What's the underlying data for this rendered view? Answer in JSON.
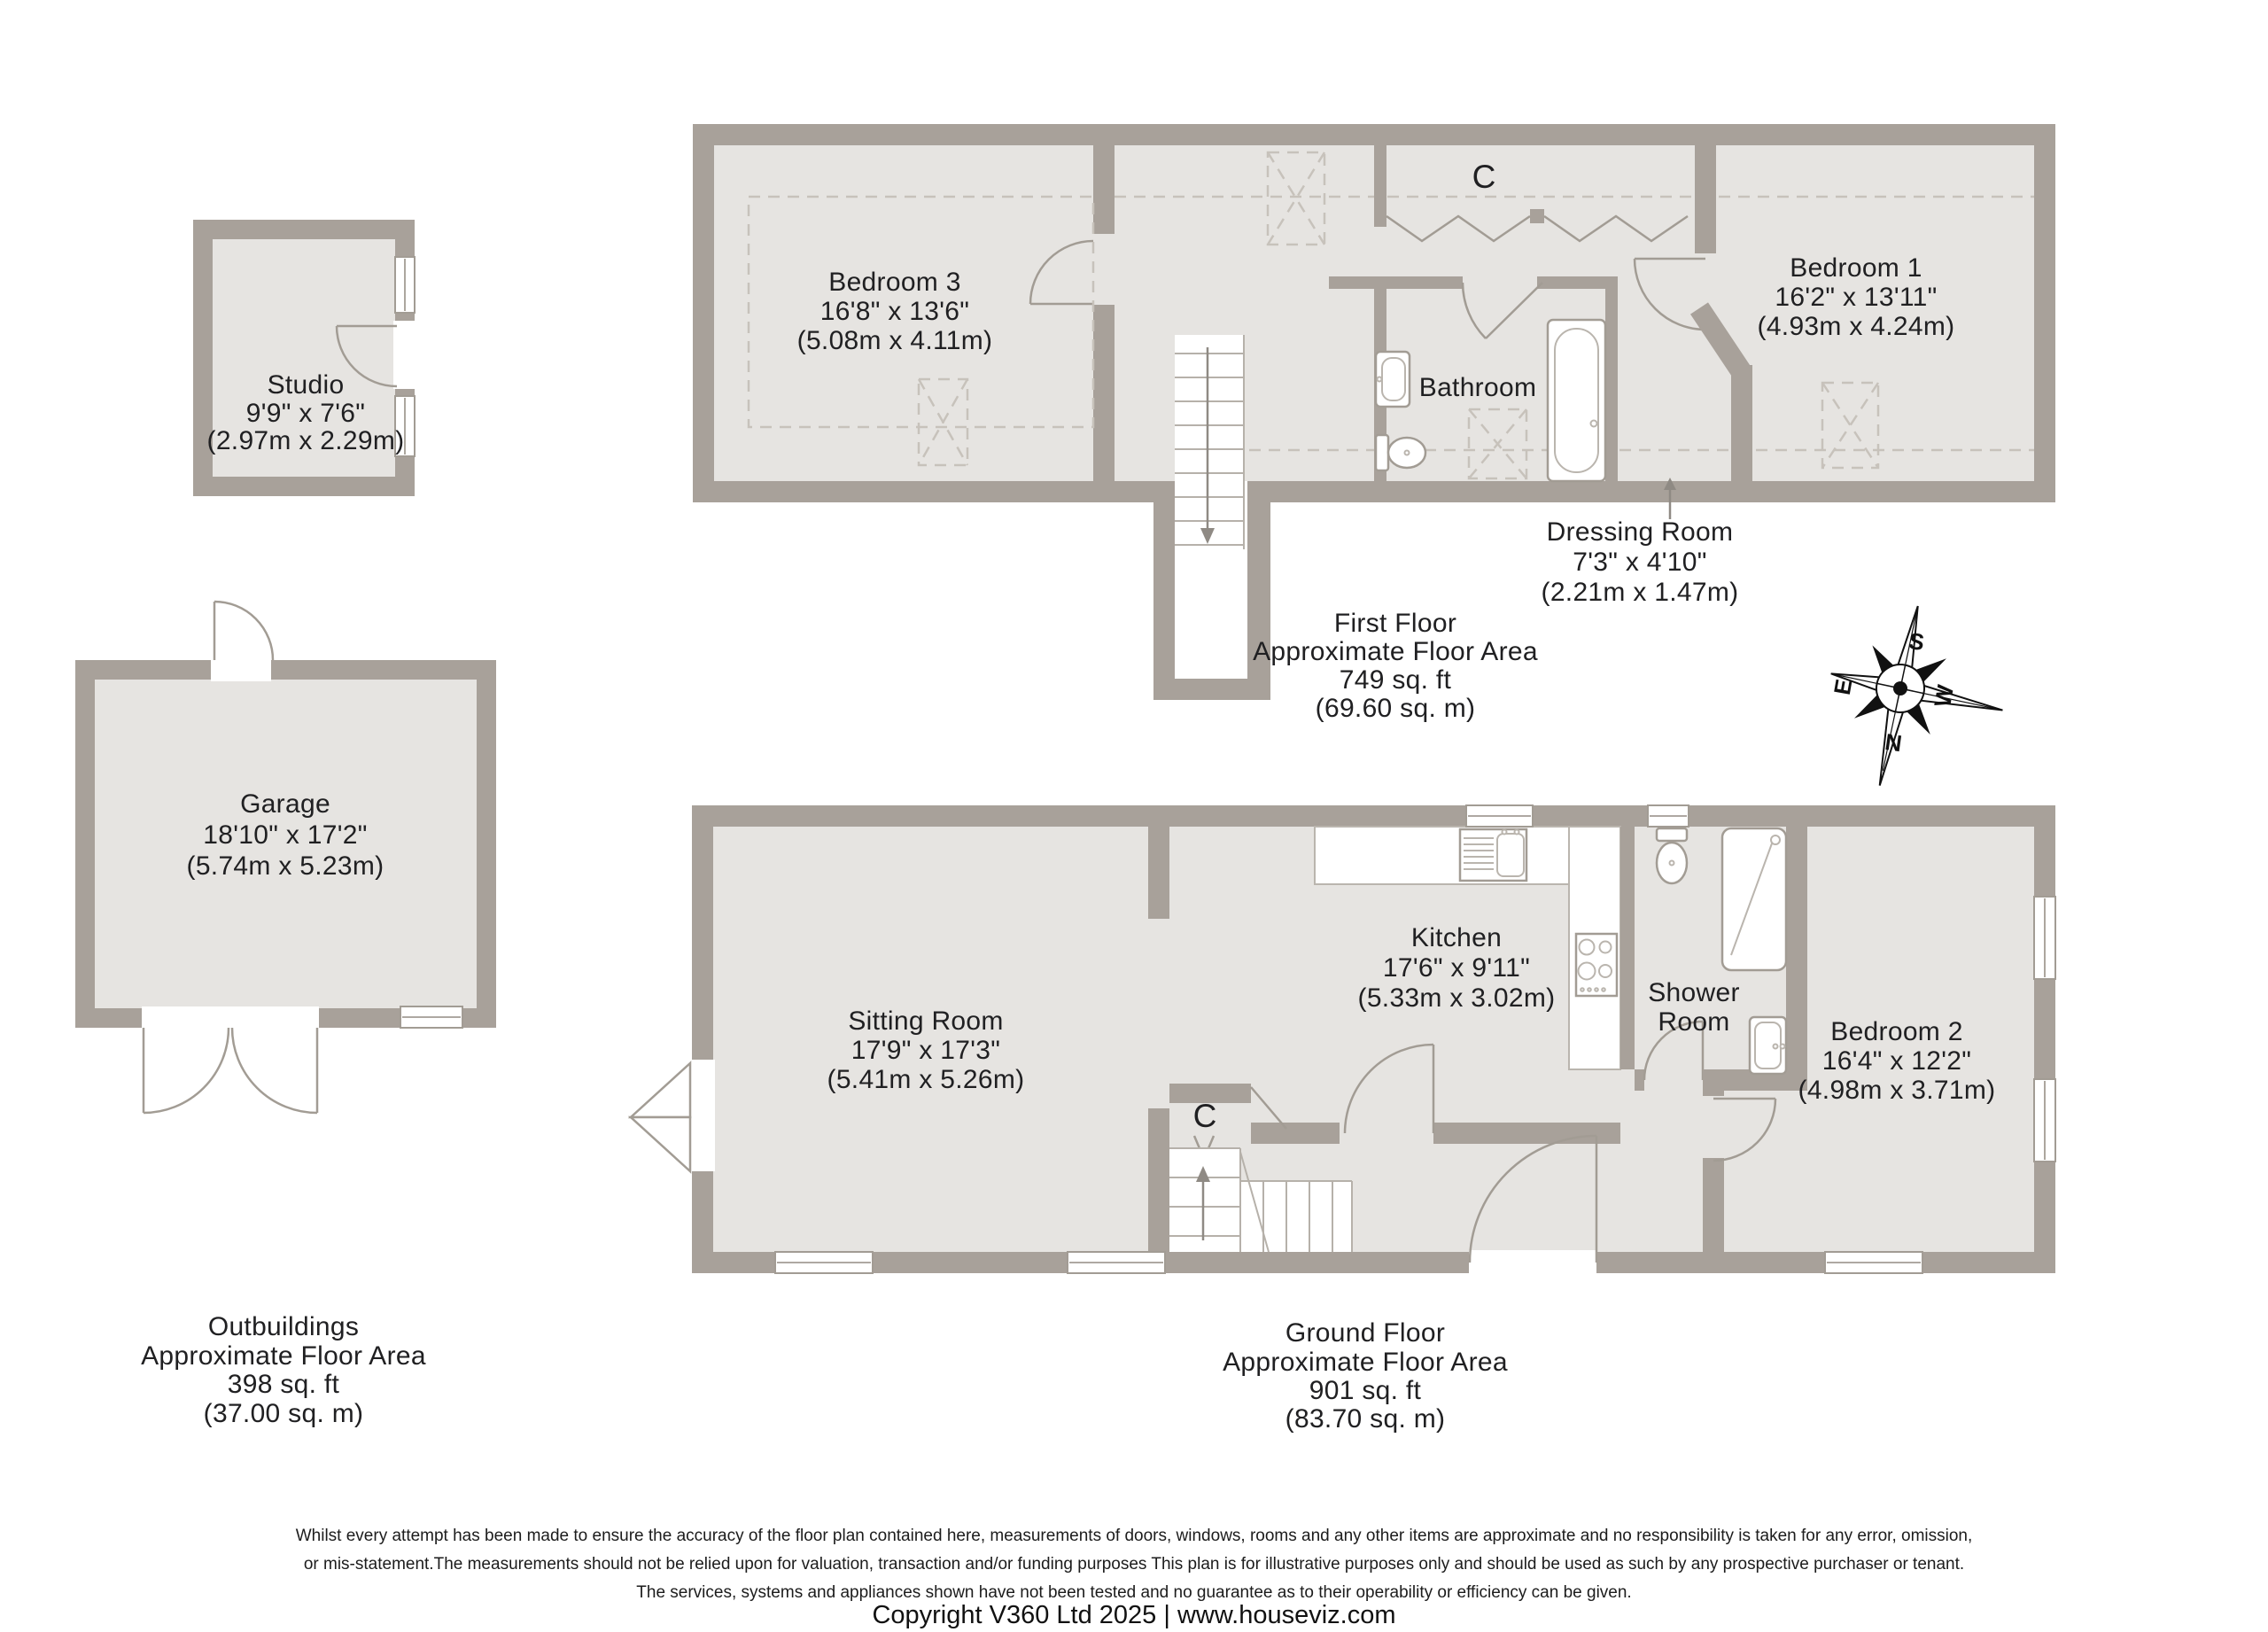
{
  "labels": {
    "closet": "C"
  },
  "compass": {
    "north": "N",
    "south": "S",
    "east": "E",
    "west": "W"
  },
  "rooms": {
    "studio": {
      "name": "Studio",
      "imperial": "9'9\" x 7'6\"",
      "metric": "(2.97m x 2.29m)"
    },
    "garage": {
      "name": "Garage",
      "imperial": "18'10\" x 17'2\"",
      "metric": "(5.74m x 5.23m)"
    },
    "bedroom3": {
      "name": "Bedroom 3",
      "imperial": "16'8\" x 13'6\"",
      "metric": "(5.08m x 4.11m)"
    },
    "bathroom": {
      "name": "Bathroom"
    },
    "bedroom1": {
      "name": "Bedroom 1",
      "imperial": "16'2\" x 13'11\"",
      "metric": "(4.93m x 4.24m)"
    },
    "dressing_room": {
      "name": "Dressing Room",
      "imperial": "7'3\" x 4'10\"",
      "metric": "(2.21m x 1.47m)"
    },
    "sitting_room": {
      "name": "Sitting Room",
      "imperial": "17'9\" x 17'3\"",
      "metric": "(5.41m x 5.26m)"
    },
    "kitchen": {
      "name": "Kitchen",
      "imperial": "17'6\" x 9'11\"",
      "metric": "(5.33m x 3.02m)"
    },
    "shower_room": {
      "name_line1": "Shower",
      "name_line2": "Room"
    },
    "bedroom2": {
      "name": "Bedroom 2",
      "imperial": "16'4\" x 12'2\"",
      "metric": "(4.98m x 3.71m)"
    }
  },
  "areas": {
    "first_floor": {
      "title": "First Floor",
      "subtitle": "Approximate Floor Area",
      "imperial": "749 sq. ft",
      "metric": "(69.60 sq. m)"
    },
    "ground_floor": {
      "title": "Ground Floor",
      "subtitle": "Approximate Floor Area",
      "imperial": "901 sq. ft",
      "metric": "(83.70 sq. m)"
    },
    "outbuildings": {
      "title": "Outbuildings",
      "subtitle": "Approximate Floor Area",
      "imperial": "398 sq. ft",
      "metric": "(37.00 sq. m)"
    }
  },
  "footer": {
    "disclaimer_line1": "Whilst every attempt has been made to ensure the accuracy of the floor plan contained here, measurements of doors, windows, rooms and any other items are approximate and no responsibility is taken for any error, omission,",
    "disclaimer_line2": "or mis-statement.The measurements should not be relied upon for valuation, transaction and/or funding purposes This plan is for illustrative purposes only and should be used as such by any prospective purchaser or tenant.",
    "disclaimer_line3": "The services, systems and appliances shown have not been tested and no guarantee as to their operability or efficiency can be given.",
    "copyright": "Copyright V360 Ltd 2025 | www.houseviz.com"
  },
  "colors": {
    "wall": "#a8a19a",
    "floor": "#e6e4e1",
    "accent_text": "#202022"
  }
}
